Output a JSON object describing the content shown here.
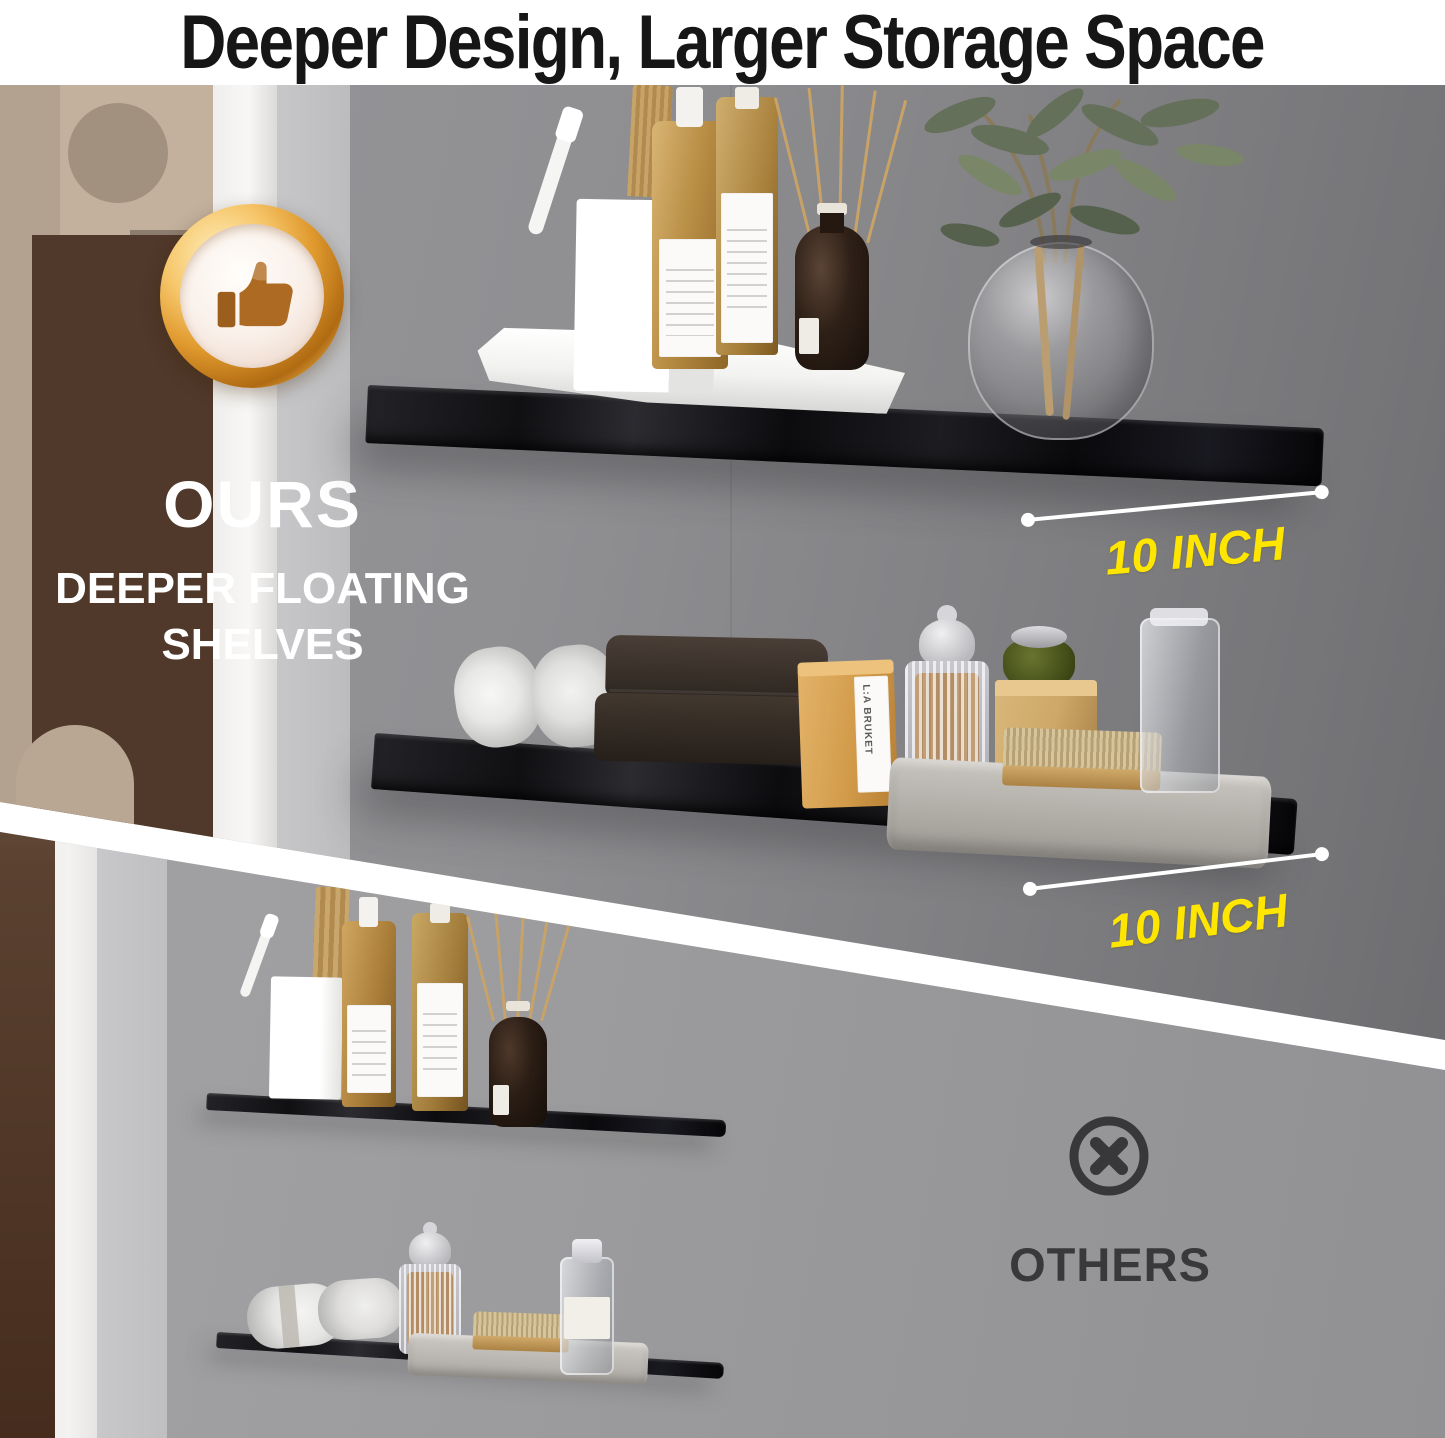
{
  "header": {
    "title": "Deeper Design, Larger Storage Space"
  },
  "ours_section": {
    "badge_icon": "thumbs-up-medal-icon",
    "heading": "OURS",
    "subheading_line1": "DEEPER FLOATING",
    "subheading_line2": "SHELVES",
    "dimensions": [
      {
        "label": "10 INCH"
      },
      {
        "label": "10 INCH"
      }
    ],
    "soap_box_brand": "L:A BRUKET",
    "shelf_top_items": [
      "white-tray",
      "toothbrush-holder",
      "white-toothbrush",
      "wooden-comb",
      "amber-pump-bottle",
      "amber-lotion-bottle",
      "reed-diffuser",
      "glass-vase-with-olive-branches"
    ],
    "shelf_middle_items": [
      "rolled-white-towels",
      "folded-brown-towels",
      "kraft-soap-box",
      "ribbed-glass-jar-with-swabs",
      "green-jar-on-wood-block",
      "wooden-brush",
      "gray-tray",
      "clear-glass-jar"
    ]
  },
  "others_section": {
    "icon": "x-circle-icon",
    "heading": "OTHERS",
    "shelf_top_items": [
      "toothbrush-holder",
      "white-toothbrush",
      "wooden-tools",
      "amber-pump-bottle",
      "amber-lotion-bottle",
      "reed-diffuser"
    ],
    "shelf_bottom_items": [
      "rolled-white-towels",
      "ribbed-glass-jar-with-swabs",
      "gray-tray",
      "wooden-brush",
      "clear-glass-bottle"
    ]
  },
  "colors": {
    "accent_yellow": "#ffe600",
    "title_black": "#161616",
    "badge_gold": "#e0a238",
    "shelf_black": "#141417",
    "others_gray": "#39393c",
    "wall_gray": "#8d8d8f"
  }
}
